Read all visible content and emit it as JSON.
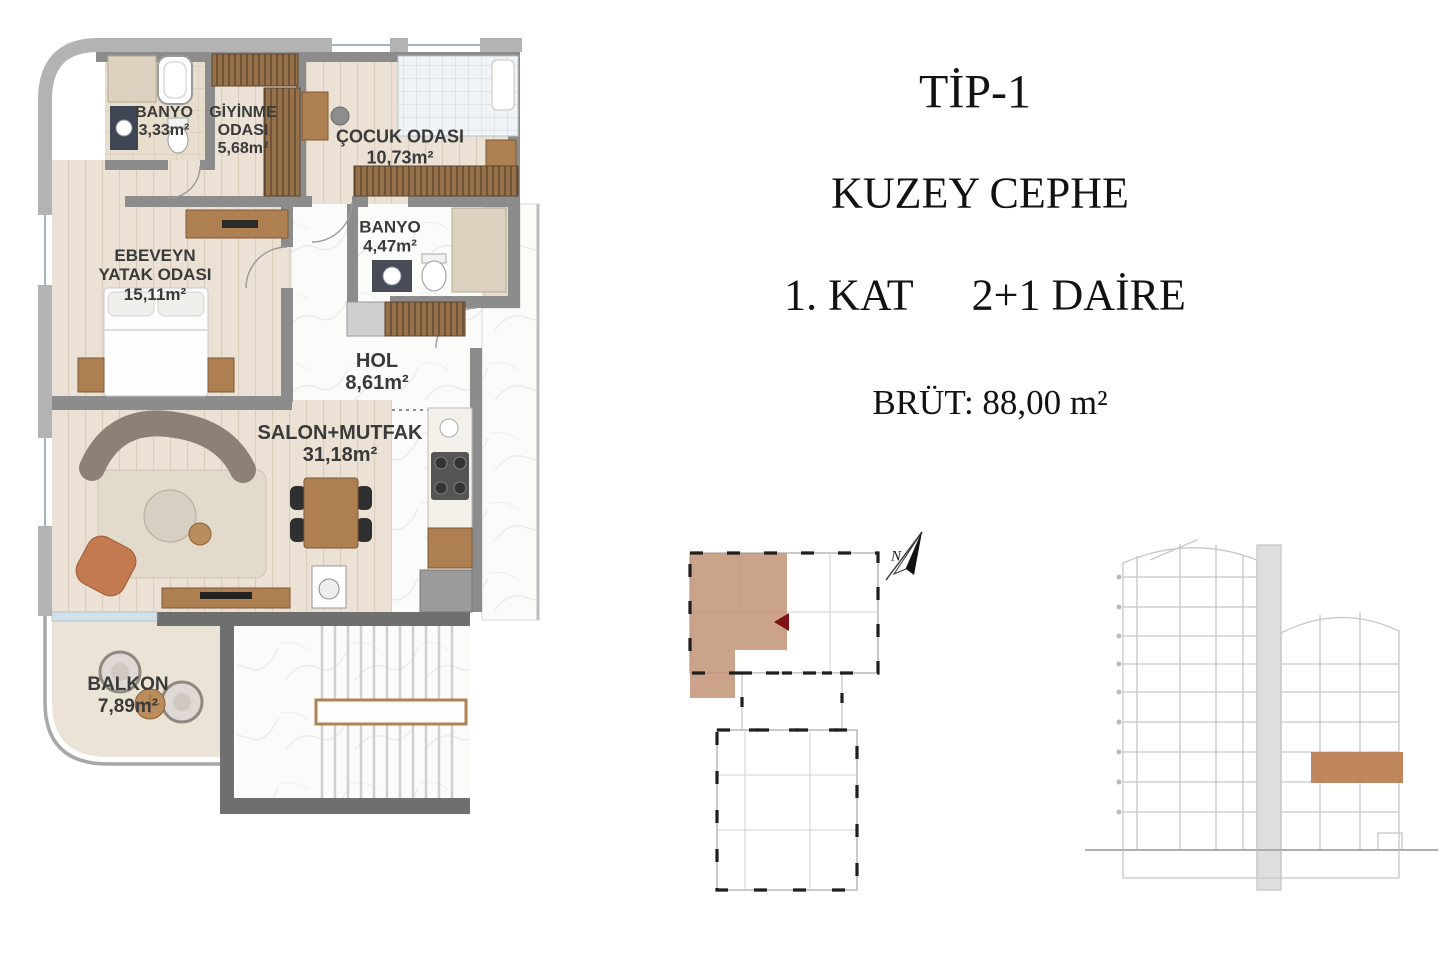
{
  "title_block": {
    "type_label": "TİP-1",
    "facade_label": "KUZEY CEPHE",
    "floor_label": "1. KAT",
    "unit_label": "2+1 DAİRE",
    "gross_area_label": "BRÜT: 88,00 m²"
  },
  "floor_plan": {
    "rooms": [
      {
        "label": "BANYO",
        "area": "3,33m²"
      },
      {
        "label": "GİYİNME\nODASI",
        "area": "5,68m²"
      },
      {
        "label": "ÇOCUK ODASI",
        "area": "10,73m²"
      },
      {
        "label": "BANYO",
        "area": "4,47m²"
      },
      {
        "label": "EBEVEYN\nYATAK ODASI",
        "area": "15,11m²"
      },
      {
        "label": "HOL",
        "area": "8,61m²"
      },
      {
        "label": "SALON+MUTFAK",
        "area": "31,18m²"
      },
      {
        "label": "BALKON",
        "area": "7,89m²"
      }
    ]
  },
  "key_plan": {
    "north_label": "N",
    "highlight_color": "#bf8f72"
  },
  "section": {
    "highlight_color": "#c0875f"
  },
  "colors": {
    "wall_dark": "#6f6f6f",
    "wall_light": "#b3b3b3",
    "wood_floor": "#ebe1d4",
    "accent_red": "#7e1416"
  }
}
